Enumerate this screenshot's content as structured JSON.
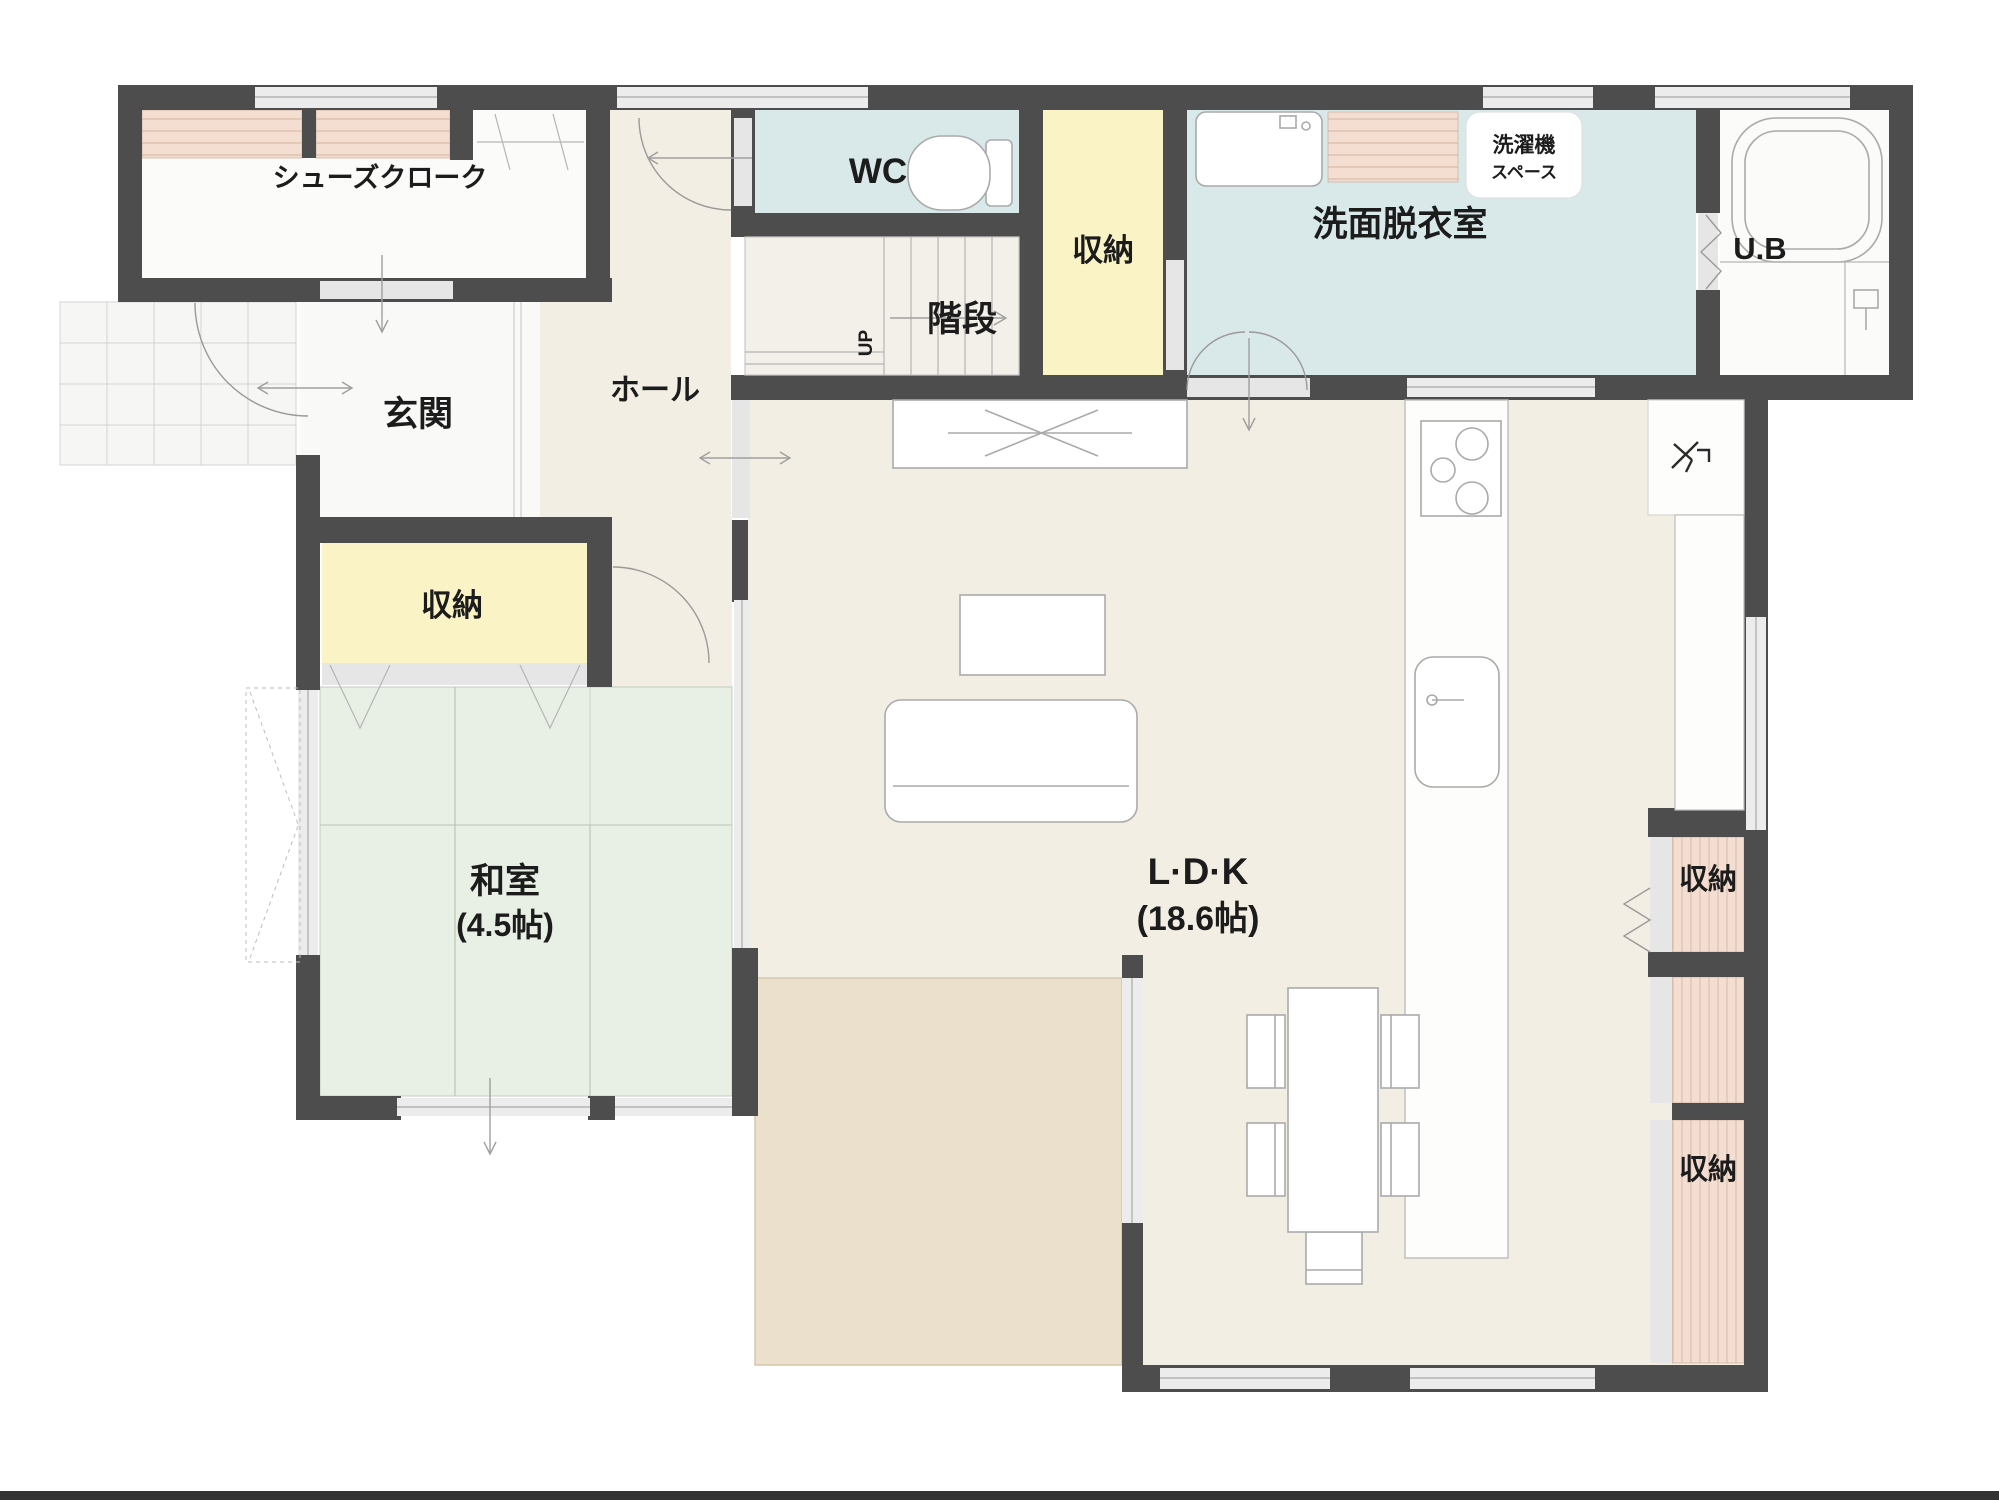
{
  "page": {
    "type": "floor-plan",
    "background": "#ffffff",
    "footer_rule_color": "#333333"
  },
  "plan": {
    "colors": {
      "wall": "#4d4d4d",
      "floor_beige": "#f2eee3",
      "tatami_green": "#e8efe4",
      "water_room_blue": "#d9e9ea",
      "storage_yellow": "#faf3c6",
      "shelf_pink": "#f4ded1",
      "shelf_stripe": "#dcc0ae",
      "deck_tan": "#ebe0cb",
      "white_room": "#fbfbfa",
      "window_gray": "#ececec",
      "label_color": "#1c1c1c"
    },
    "rooms": {
      "shoes_closet": {
        "label": "シューズクローク"
      },
      "entrance": {
        "label": "玄関"
      },
      "hall": {
        "label": "ホール"
      },
      "wc": {
        "label": "WC"
      },
      "stairs": {
        "label": "階段",
        "direction": "UP"
      },
      "stairs_storage": {
        "label": "収納"
      },
      "washroom": {
        "label": "洗面脱衣室"
      },
      "washer_space": {
        "line1": "洗濯機",
        "line2": "スペース"
      },
      "unit_bath": {
        "label": "U.B"
      },
      "entrance_storage": {
        "label": "収納"
      },
      "japanese_room": {
        "label": "和室",
        "size": "(4.5帖)"
      },
      "ldk": {
        "label": "L·D·K",
        "size": "(18.6帖)"
      },
      "storage_right_top": {
        "label": "収納"
      },
      "storage_right_bottom": {
        "label": "収納"
      }
    }
  }
}
